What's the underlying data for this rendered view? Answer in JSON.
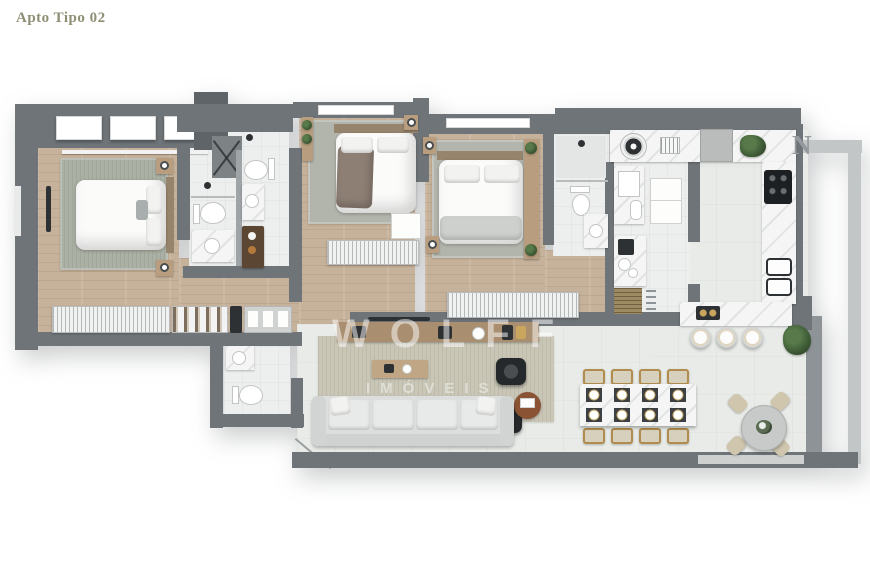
{
  "page": {
    "title": "Apto Tipo 02"
  },
  "watermark": {
    "line1": "WOLFF",
    "line2": "IMÓVEIS"
  },
  "compass": {
    "letter": "N"
  },
  "palette": {
    "wall": "#6e7478",
    "wall_dark": "#5f6468",
    "wall_light": "#c2c6c6",
    "wall_medium": "#8d9396",
    "wood_floor": "#c6b29b",
    "tile": "#edefee",
    "marble_floor": "#e9ebe8",
    "counter": "#f4f5f4",
    "rug_green": "#abb0a4",
    "rug_beige": "#c9c6b6",
    "furniture_wood": "#b89e7e",
    "gold": "#b08d4e",
    "plant": "#3f5c37",
    "dark_item": "#2e3133",
    "title": "#8e8e75",
    "watermark": "rgba(255,255,255,0.5)",
    "north": "#959a9e"
  }
}
